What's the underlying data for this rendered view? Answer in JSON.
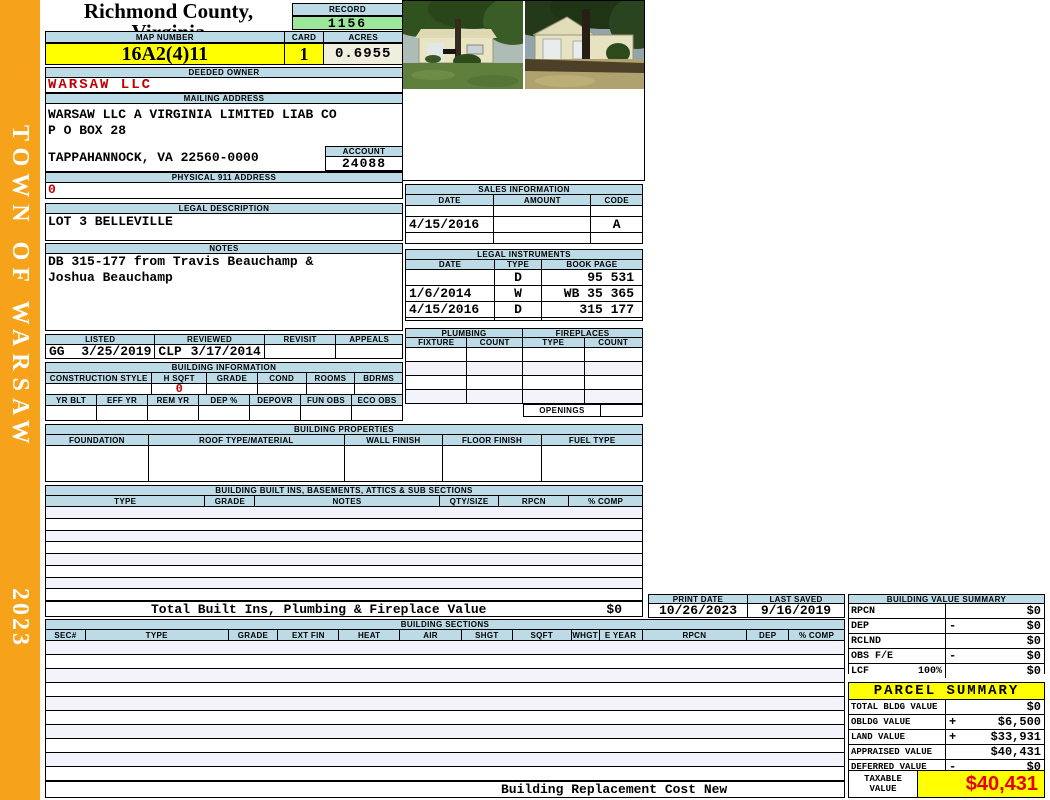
{
  "sidebar": {
    "title": "TOWN OF WARSAW",
    "year": "2023"
  },
  "header": {
    "county": "Richmond County, Virginia",
    "commissioner": "Commissioner of the Revenue, PO Box 366, Warsaw, VA 22572",
    "record_label": "RECORD",
    "record": "1156",
    "map_number_label": "MAP NUMBER",
    "map_number": "16A2(4)11",
    "card_label": "CARD",
    "card": "1",
    "acres_label": "ACRES",
    "acres": "0.6955"
  },
  "owner": {
    "deeded_owner_label": "DEEDED OWNER",
    "deeded_owner": "WARSAW LLC",
    "mailing_address_label": "MAILING ADDRESS",
    "mailing_line1": "WARSAW LLC A VIRGINIA LIMITED LIAB CO",
    "mailing_line2": "P O BOX 28",
    "mailing_line3": "TAPPAHANNOCK, VA 22560-0000",
    "account_label": "ACCOUNT",
    "account": "24088",
    "physical_address_label": "PHYSICAL 911 ADDRESS",
    "physical_address": "0"
  },
  "legal": {
    "label": "LEGAL DESCRIPTION",
    "description": "LOT 3 BELLEVILLE",
    "notes_label": "NOTES",
    "notes_line1": "DB 315-177 from Travis Beauchamp &",
    "notes_line2": "Joshua Beauchamp"
  },
  "review": {
    "headers": [
      "LISTED",
      "REVIEWED",
      "REVISIT",
      "APPEALS"
    ],
    "listed_by": "GG",
    "listed_date": "3/25/2019",
    "reviewed_by": "CLP",
    "reviewed_date": "3/17/2014",
    "revisit": "",
    "appeals": ""
  },
  "building_info": {
    "label": "BUILDING INFORMATION",
    "row1_headers": [
      "CONSTRUCTION STYLE",
      "H SQFT",
      "GRADE",
      "COND",
      "ROOMS",
      "BDRMS"
    ],
    "h_sqft": "0",
    "row2_headers": [
      "YR BLT",
      "EFF YR",
      "REM YR",
      "DEP %",
      "DEPOVR",
      "FUN OBS",
      "ECO OBS"
    ]
  },
  "building_properties": {
    "label": "BUILDING PROPERTIES",
    "headers": [
      "FOUNDATION",
      "ROOF TYPE/MATERIAL",
      "WALL FINISH",
      "FLOOR FINISH",
      "FUEL TYPE"
    ]
  },
  "built_ins": {
    "label": "BUILDING BUILT INS, BASEMENTS, ATTICS & SUB SECTIONS",
    "headers": [
      "TYPE",
      "GRADE",
      "NOTES",
      "QTY/SIZE",
      "RPCN",
      "% COMP"
    ],
    "total_label": "Total Built Ins, Plumbing & Fireplace Value",
    "total_value": "$0"
  },
  "sales": {
    "label": "SALES INFORMATION",
    "headers": [
      "DATE",
      "AMOUNT",
      "CODE"
    ],
    "rows": [
      [
        "",
        "",
        ""
      ],
      [
        "4/15/2016",
        "",
        "A"
      ],
      [
        "",
        "",
        ""
      ]
    ]
  },
  "instruments": {
    "label": "LEGAL INSTRUMENTS",
    "headers": [
      "DATE",
      "TYPE",
      "BOOK PAGE"
    ],
    "rows": [
      [
        "",
        "D",
        "95 531"
      ],
      [
        "1/6/2014",
        "W",
        "WB 35 365"
      ],
      [
        "4/15/2016",
        "D",
        "315 177"
      ],
      [
        "",
        "",
        ""
      ]
    ]
  },
  "plumbing": {
    "label": "PLUMBING",
    "headers": [
      "FIXTURE",
      "COUNT"
    ]
  },
  "fireplaces": {
    "label": "FIREPLACES",
    "headers": [
      "TYPE",
      "COUNT"
    ],
    "openings_label": "OPENINGS",
    "openings": ""
  },
  "dates": {
    "print_date_label": "PRINT DATE",
    "print_date": "10/26/2023",
    "last_saved_label": "LAST SAVED",
    "last_saved": "9/16/2019"
  },
  "building_value_summary": {
    "label": "BUILDING VALUE SUMMARY",
    "rows": [
      {
        "label": "RPCN",
        "extra": "",
        "op": "",
        "value": "$0"
      },
      {
        "label": "DEP",
        "extra": "",
        "op": "-",
        "value": "$0"
      },
      {
        "label": "RCLND",
        "extra": "",
        "op": "",
        "value": "$0"
      },
      {
        "label": "OBS F/E",
        "extra": "",
        "op": "-",
        "value": "$0"
      },
      {
        "label": "LCF",
        "extra": "100%",
        "op": "",
        "value": "$0"
      }
    ]
  },
  "building_sections": {
    "label": "BUILDING SECTIONS",
    "headers": [
      "SEC#",
      "TYPE",
      "GRADE",
      "EXT FIN",
      "HEAT",
      "AIR",
      "SHGT",
      "SQFT",
      "WHGT",
      "E YEAR",
      "RPCN",
      "DEP",
      "% COMP"
    ]
  },
  "parcel_summary": {
    "label": "PARCEL SUMMARY",
    "rows": [
      {
        "label": "TOTAL BLDG VALUE",
        "op": "",
        "value": "$0"
      },
      {
        "label": "OBLDG VALUE",
        "op": "+",
        "value": "$6,500"
      },
      {
        "label": "LAND VALUE",
        "op": "+",
        "value": "$33,931"
      },
      {
        "label": "APPRAISED VALUE",
        "op": "",
        "value": "$40,431"
      },
      {
        "label": "DEFERRED VALUE",
        "op": "-",
        "value": "$0"
      }
    ],
    "taxable_label": "TAXABLE VALUE",
    "taxable_value": "$40,431"
  },
  "footer": {
    "text": "Building Replacement Cost New"
  },
  "photos": {
    "left": "house front with tree and lawn",
    "right": "house side with two garage doors"
  },
  "colors": {
    "header_blue": "#BDDBE7",
    "record_green": "#9CE79C",
    "highlight_yellow": "#FFFF00",
    "cream": "#F0EFDE",
    "sidebar_orange": "#F6A21B",
    "value_red": "#C00000",
    "taxable_red": "#E80000"
  }
}
